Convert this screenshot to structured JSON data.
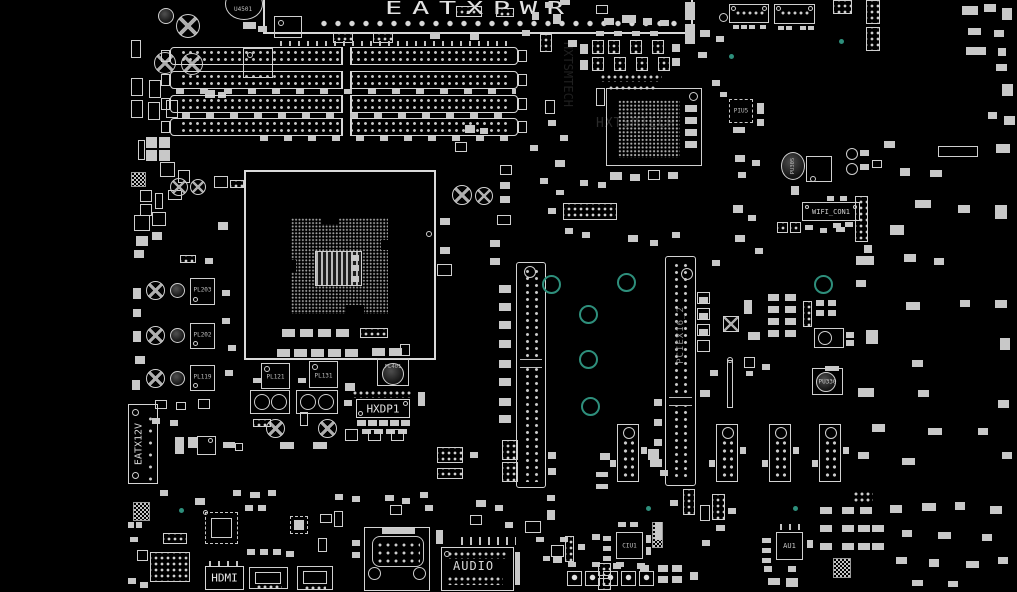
{
  "view": {
    "background": "#000000",
    "trace_color": "#d6d6d6",
    "mounting_hole_color": "#2e8f7c",
    "watermark_color": "#2b2b2b"
  },
  "labels": {
    "eatxpwr": "EATXPWR",
    "u4501": "U4501",
    "eatx12v": "EATX12V",
    "hxdp1": "HXDP1",
    "pciex16_2": "PCIEX16_2",
    "wifi_con1": "WIFI_CON1",
    "hdmi": "HDMI",
    "audio": "AUDIO",
    "ciu1": "CIU1",
    "au1": "AU1",
    "piu5": "PIU5",
    "pu305": "PU305",
    "pu330": "PU330",
    "pl121": "PL121",
    "pl131": "PL131",
    "pl401": "PL401",
    "pl203": "PL203",
    "pl202": "PL202",
    "pl119": "PL119",
    "watermark": "HXTSMTECH"
  }
}
